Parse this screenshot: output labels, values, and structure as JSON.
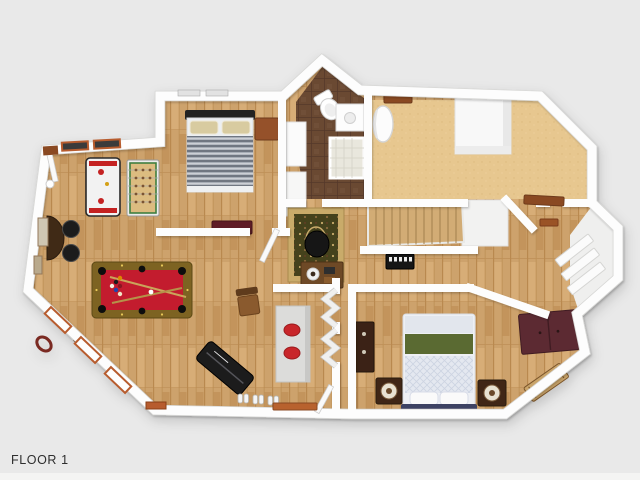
{
  "scene": {
    "floor_label": "FLOOR 1",
    "view": "top-down 3D rendered floor plan",
    "rooms": [
      {
        "name": "bedroom-top-left",
        "floor": "hardwood"
      },
      {
        "name": "bathroom",
        "floor": "brown-tile"
      },
      {
        "name": "bonus-room",
        "floor": "tan-carpet"
      },
      {
        "name": "game-room",
        "floor": "hardwood"
      },
      {
        "name": "family-room",
        "floor": "hardwood"
      },
      {
        "name": "hallway",
        "floor": "hardwood"
      },
      {
        "name": "stairwell",
        "floor": "wood-stairs"
      },
      {
        "name": "bedroom-bottom-right",
        "floor": "hardwood"
      },
      {
        "name": "closet-right",
        "floor": "white"
      }
    ],
    "furniture": [
      "striped-bed",
      "dresser-top",
      "bench-maroon",
      "air-hockey-table",
      "foosball-table",
      "bar-counter",
      "bar-stool",
      "bar-stool",
      "pool-table",
      "cue-rack",
      "wall-wreath",
      "picture-frame",
      "black-sofa",
      "shoe-pairs",
      "gray-table-with-red-plates",
      "wooden-chair",
      "oriental-rug",
      "armchair",
      "writing-desk",
      "keyboard-piano",
      "staircase",
      "stair-landing",
      "toilet",
      "vanity-cabinet",
      "shower",
      "linen-closet",
      "water-heater",
      "wall-shelf",
      "quilted-bed",
      "nightstand-lamp-left",
      "nightstand-lamp-right",
      "maroon-dresser",
      "accent-rug",
      "console-cabinet",
      "closet-shelves",
      "front-door-mat",
      "windows",
      "door-mat-upper"
    ],
    "palette": {
      "background": "#e9e9e9",
      "background_strip": "#f4f4f3",
      "label_text": "#2e2e2e",
      "wall": "#fdfdfd",
      "wall_edge": "#d7d7d5",
      "wood_floor": "#cda26c",
      "wood_dark": "#b98950",
      "carpet": "#e7c78f",
      "tile": "#6b4a33",
      "stair_wood": "#d2ac74",
      "pool_felt": "#c31f2e",
      "pool_rail": "#7d6320",
      "trim_orange": "#b75c2e",
      "blanket_green": "#5a6a33",
      "quilt_blue": "#e4e8f0",
      "navy_footboard": "#3c4263",
      "nightstand_brown": "#3f2817",
      "dresser_maroon": "#5c2b33",
      "rug_field": "#45421f",
      "rug_border": "#c9ab6b",
      "table_gray": "#dcdcda",
      "plate_red": "#c8252a",
      "sofa_black": "#1d1d1f"
    }
  }
}
